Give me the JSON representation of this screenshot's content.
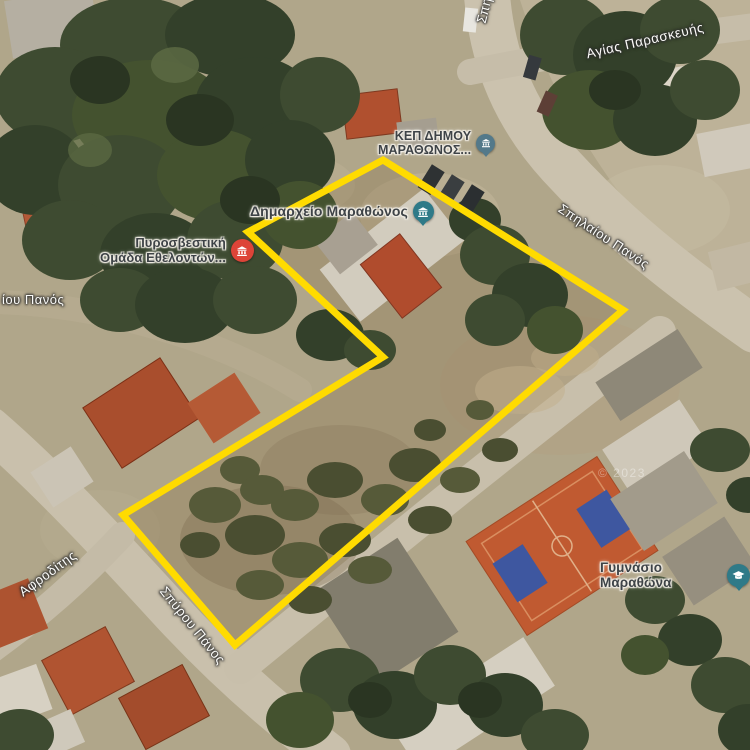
{
  "map": {
    "view_type": "satellite",
    "attribution": "© 2023",
    "boundary": {
      "color": "#FFDB00",
      "vertices": [
        [
          383,
          160
        ],
        [
          623,
          310
        ],
        [
          235,
          645
        ],
        [
          123,
          515
        ],
        [
          383,
          357
        ],
        [
          248,
          232
        ]
      ]
    },
    "pois": [
      {
        "id": "kep",
        "line1": "ΚΕΠ ΔΗΜΟΥ",
        "line2": "ΜΑΡΑΘΩΝΟΣ...",
        "icon": "government-office-icon",
        "color": "#53798a"
      },
      {
        "id": "dimarxeio",
        "label": "Δημαρχείο Μαραθώνος",
        "icon": "town-hall-icon",
        "color": "#2f7a88"
      },
      {
        "id": "fire",
        "line1": "Πυροσβεστική",
        "line2": "Ομάδα Εθελοντών...",
        "icon": "fire-station-icon",
        "color": "#dd4438"
      },
      {
        "id": "gym",
        "label": "Γυμνάσιο Μαραθώνα",
        "icon": "school-icon",
        "color": "#2f7a88"
      }
    ],
    "streets": {
      "agias_paraskevis": "Αγίας Παρασκευής",
      "spilaiou_panos": "Σπηλαίου Πανός",
      "spilaiou_truncated": "Σπηλαίου",
      "iou_panos": "ίου Πανός",
      "afroditis": "Αφροδίτης",
      "spyrou_panos": "Σπύρου Πάνος"
    }
  }
}
